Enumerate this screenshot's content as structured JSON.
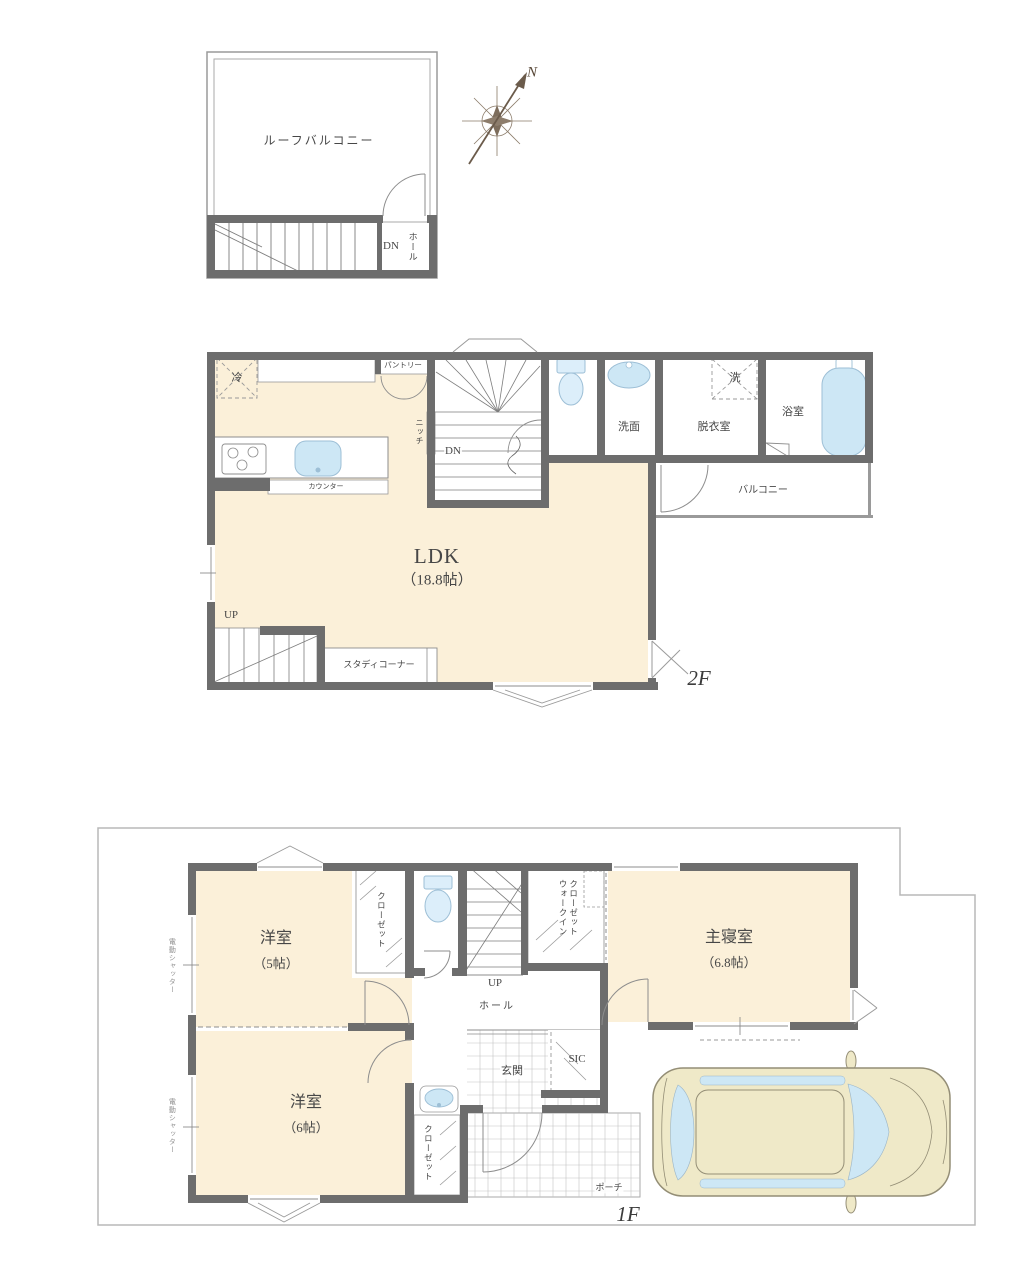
{
  "colors": {
    "wall": "#6d6d6d",
    "room_cream": "#fbf0d9",
    "fixture_blue": "#cde7f5",
    "car_body": "#efe9c8",
    "boundary_gray": "#b8b8b8"
  },
  "compass": {
    "north": "N"
  },
  "roof_floor": {
    "balcony": "ルーフバルコニー",
    "down": "DN",
    "hall": "ホール"
  },
  "floor_2": {
    "fridge": "冷",
    "pantry": "パントリー",
    "niche": "ニッチ",
    "down": "DN",
    "washroom": "洗面",
    "washer": "洗",
    "dressing_room": "脱衣室",
    "bathroom": "浴室",
    "balcony": "バルコニー",
    "counter": "カウンター",
    "ldk": "LDK",
    "ldk_size": "（18.8帖）",
    "up": "UP",
    "study_corner": "スタディコーナー",
    "floor_label": "2F"
  },
  "floor_1": {
    "shutter": "電動シャッター",
    "western_room_5": "洋室",
    "western_room_5_size": "（5帖）",
    "closet": "クローゼット",
    "walk_in_closet": "ウォークイン\nクローゼット",
    "master_bedroom": "主寝室",
    "master_bedroom_size": "（6.8帖）",
    "up": "UP",
    "hall": "ホール",
    "entrance": "玄関",
    "shoe_closet": "SIC",
    "western_room_6": "洋室",
    "western_room_6_size": "（6帖）",
    "porch": "ポーチ",
    "floor_label": "1F"
  }
}
